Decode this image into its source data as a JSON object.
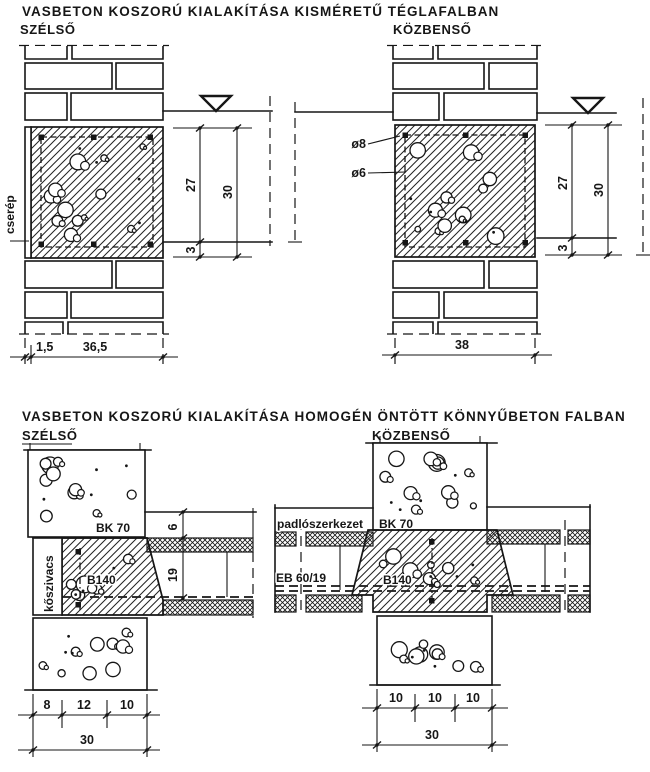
{
  "s1": {
    "title": "VASBETON KOSZORÚ KIALAKÍTÁSA KISMÉRETŰ TÉGLAFALBAN",
    "left_label": "SZÉLSŐ",
    "right_label": "KÖZBENSŐ",
    "tile_label": "cserép",
    "rebar_main": "ø8",
    "rebar_stirrup": "ø6",
    "dim_beam": "27",
    "dim_total": "30",
    "dim_cover": "3",
    "dim_tile": "1,5",
    "dim_wall_left": "36,5",
    "dim_wall_right": "38"
  },
  "s2": {
    "title": "VASBETON KOSZORÚ KIALAKÍTÁSA HOMOGÉN ÖNTÖTT KÖNNYŰBETON FALBAN",
    "left_label": "SZÉLSŐ",
    "right_label": "KÖZBENSŐ",
    "wall_material": "BK 70",
    "insulation_label": "kőszivacs",
    "concrete_label": "B140",
    "floor_label": "padlószerkezet",
    "slab_label": "EB 60/19",
    "dim_floor": "6",
    "dim_slab": "19",
    "dim_l1": "8",
    "dim_l2": "12",
    "dim_l3": "10",
    "dim_ltotal": "30",
    "dim_r1": "10",
    "dim_r2": "10",
    "dim_r3": "10",
    "dim_rtotal": "30"
  }
}
